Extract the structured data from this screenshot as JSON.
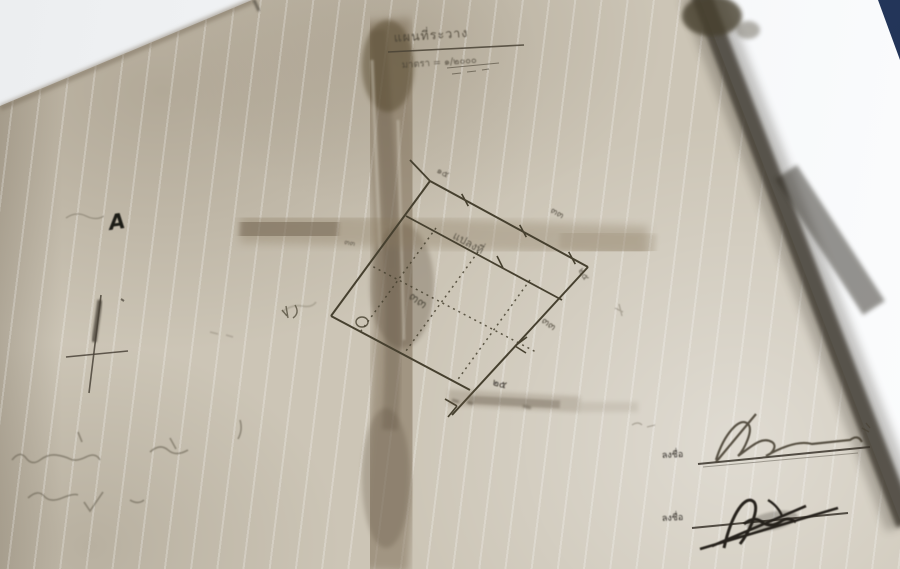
{
  "map": {
    "title": "แผนที่ระวาง",
    "scale": "มาตรา = ๑/๒๐๐๐",
    "north_mark": "A",
    "plot": {
      "strip_label": "แปลงที่",
      "area_number": "๓๓",
      "corner_top": "๑๕",
      "edge_top_right": "๓๓",
      "corner_right": "๒๕",
      "edge_lower_right": "๓๓",
      "edge_left": "๓๓",
      "corner_bottom": "๒๕"
    },
    "signatures": [
      {
        "label": "ลงชื่อ"
      },
      {
        "label": "ลงชื่อ"
      }
    ],
    "colors": {
      "paper_white": "#edeff1",
      "map_beige": "#ccc5b6",
      "ink": "#46402f",
      "pencil": "#6e6758",
      "backdrop_navy": "#22355c"
    }
  }
}
